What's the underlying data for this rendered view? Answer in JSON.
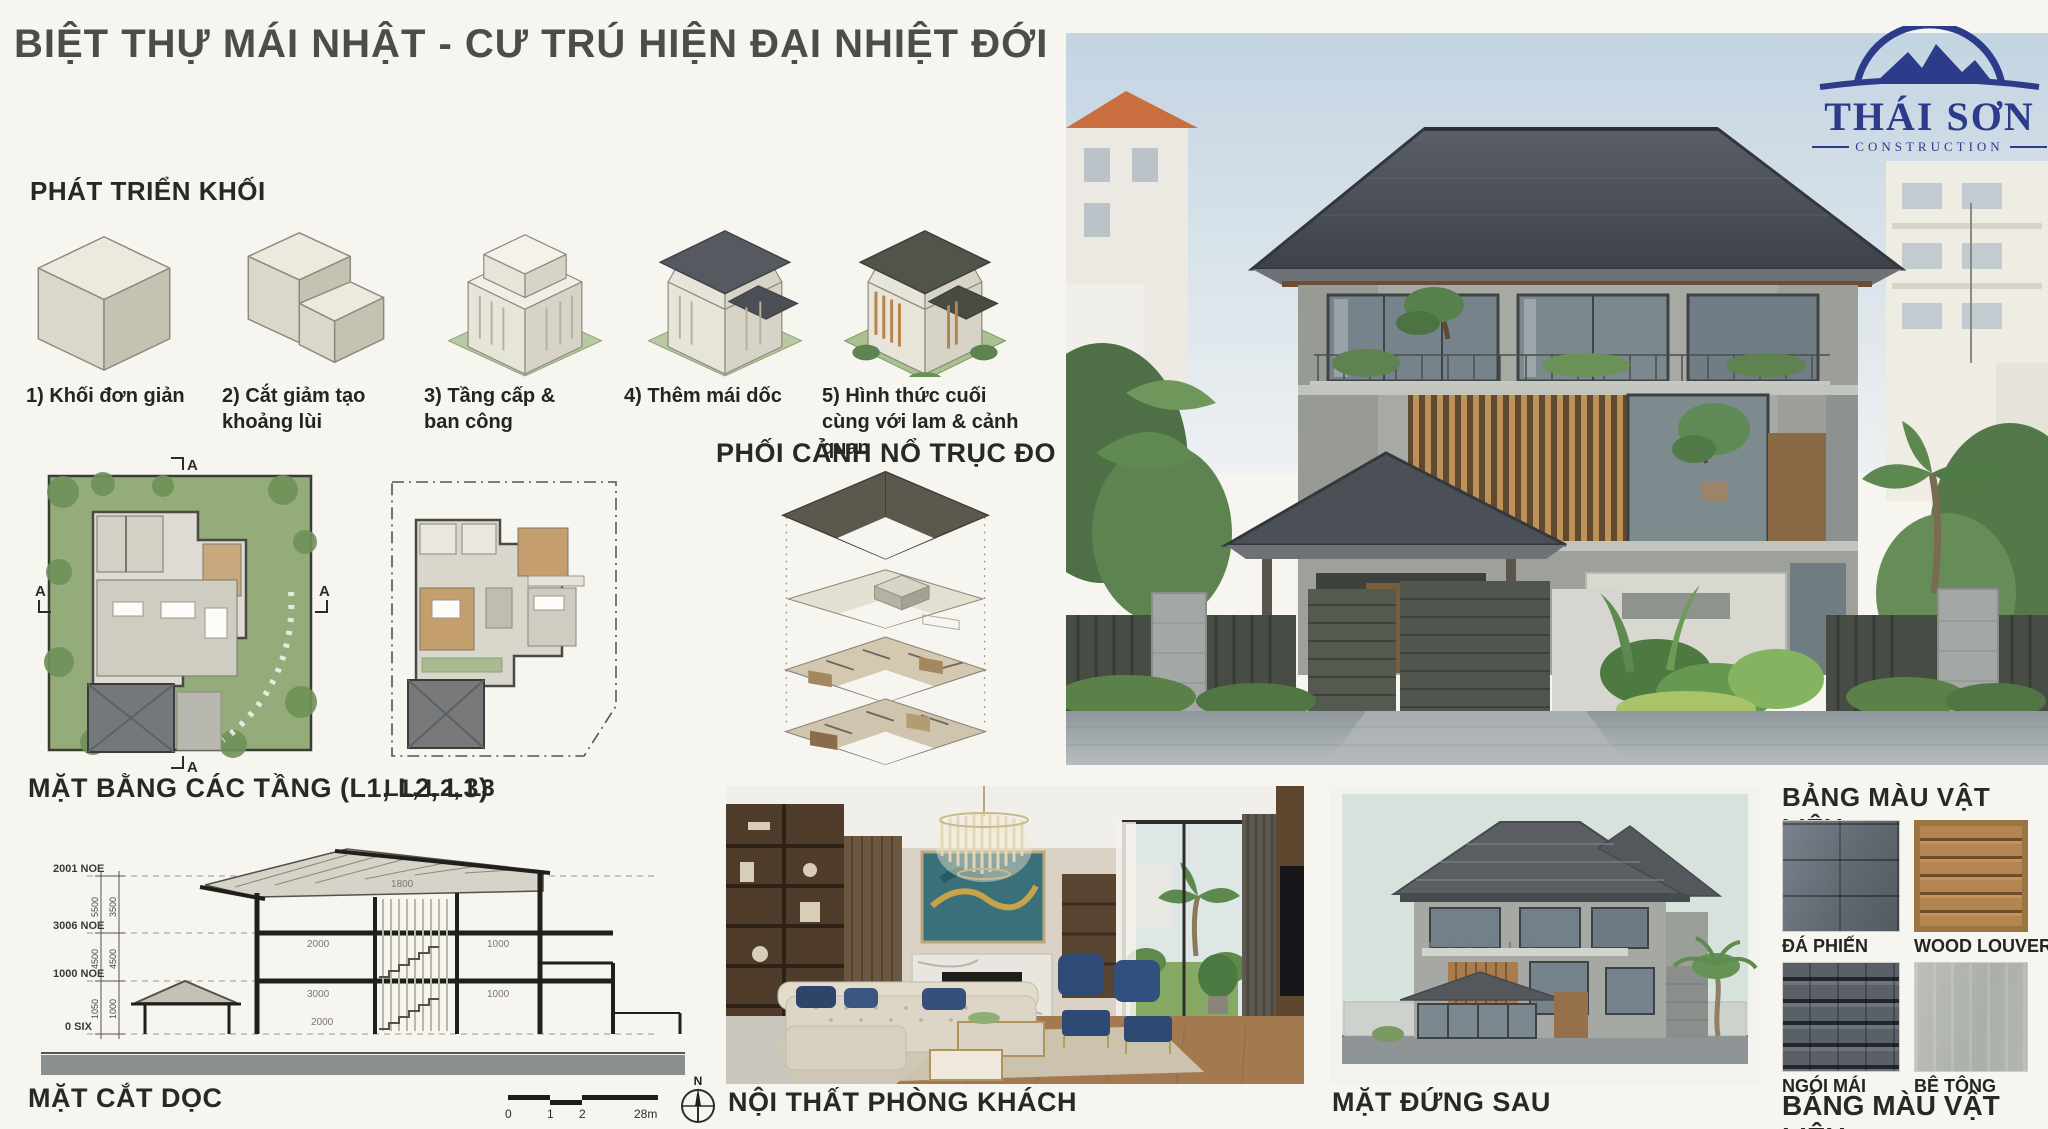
{
  "title": "BIỆT THỰ MÁI NHẬT - CƯ TRÚ HIỆN ĐẠI NHIỆT ĐỚI",
  "logo": {
    "name": "THÁI SƠN",
    "subtitle": "CONSTRUCTION"
  },
  "mass_development": {
    "heading": "PHÁT TRIỂN KHỐI",
    "steps": [
      {
        "label": "1) Khối đơn giản"
      },
      {
        "label": "2) Cắt giảm tạo khoảng lùi"
      },
      {
        "label": "3) Tầng cấp & ban công"
      },
      {
        "label": "4) Thêm mái dốc"
      },
      {
        "label": "5) Hình thức cuối cùng với lam & cảnh quan"
      }
    ]
  },
  "floor_plans": {
    "label": "MẶT BẰNG CÁC TẦNG (L1, L2, L3)",
    "sub_label": "L1, L2, L3",
    "section_marker": "A"
  },
  "exploded_axon": {
    "heading": "PHỐI CẢNH NỔ TRỤC ĐO"
  },
  "section_drawing": {
    "label": "MẶT CẮT DỌC",
    "level_labels": [
      "2001 NOE",
      "3006 NOE",
      "1000 NOE",
      "0 SIX"
    ],
    "dim_column_1": [
      "5500",
      "4500",
      "1050"
    ],
    "dim_column_2": [
      "3500",
      "4500",
      "1000"
    ],
    "inner_dims": [
      "1800",
      "2000",
      "1000",
      "3000",
      "1000",
      "2000"
    ],
    "scale_ticks": [
      "0",
      "1",
      "2",
      "28m"
    ],
    "north_label": "N"
  },
  "interior": {
    "label": "NỘI THẤT PHÒNG KHÁCH"
  },
  "rear_elevation": {
    "label": "MẶT ĐỨNG SAU"
  },
  "materials": {
    "heading_top": "BẢNG MÀU VẬT LIỆU",
    "heading_bottom": "BẢNG MÀU VẬT LIỆU",
    "swatches": [
      {
        "label": "ĐÁ PHIẾN",
        "color": "#636b74"
      },
      {
        "label": "WOOD LOUVERS",
        "color": "#a97f4f"
      },
      {
        "label": "NGÓI MÁI",
        "color": "#3f444b"
      },
      {
        "label": "BÊ TÔNG",
        "color": "#b2b5af"
      }
    ]
  },
  "colors": {
    "background": "#f6f5f0",
    "logo_navy": "#2c3b8a",
    "roof_dark": "#4a4f56",
    "concrete_gray": "#a6aaa2",
    "wood_louver": "#b5854d",
    "lawn_green": "#93ac79",
    "heading_text": "#282824"
  }
}
